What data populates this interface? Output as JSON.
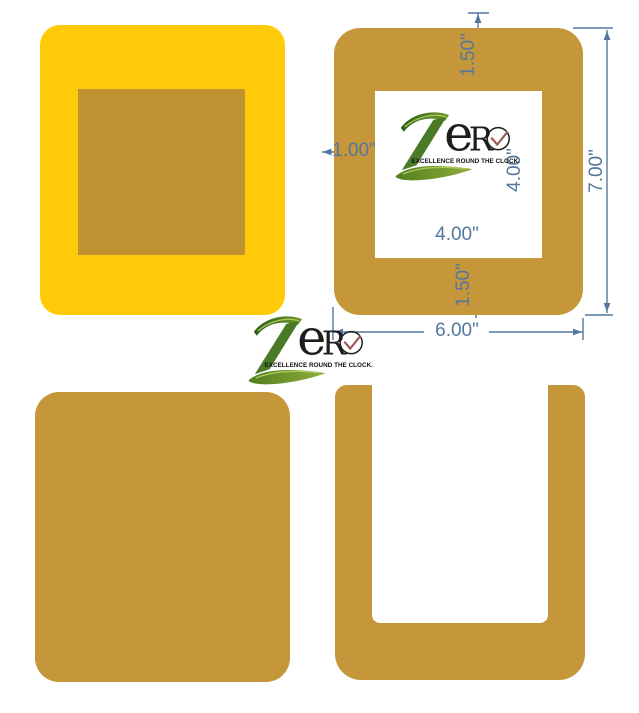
{
  "canvas": {
    "width": 639,
    "height": 713,
    "background": "#ffffff"
  },
  "brand": {
    "letter_z": "Z",
    "letter_e": "e",
    "letter_r": "R",
    "tagline": "EXCELLENCE ROUND THE CLOCK."
  },
  "dimensions": {
    "top_border": "1.50\"",
    "left_border": "1.00\"",
    "inner_height": "4.00\"",
    "inner_width": "4.00\"",
    "bottom_border": "1.50\"",
    "outer_width": "6.00\"",
    "outer_height": "7.00\""
  },
  "colors": {
    "yellow_piece": "#FFCA08",
    "mustard_piece": "#C6973A",
    "insert_square": "#C09232",
    "dimension_lines": "#54779F",
    "logo_green_dark": "#2F5C16",
    "logo_green_light": "#8FAE3A",
    "logo_letters": "#1D1D1D",
    "clock_hands": "#9C5A52"
  }
}
